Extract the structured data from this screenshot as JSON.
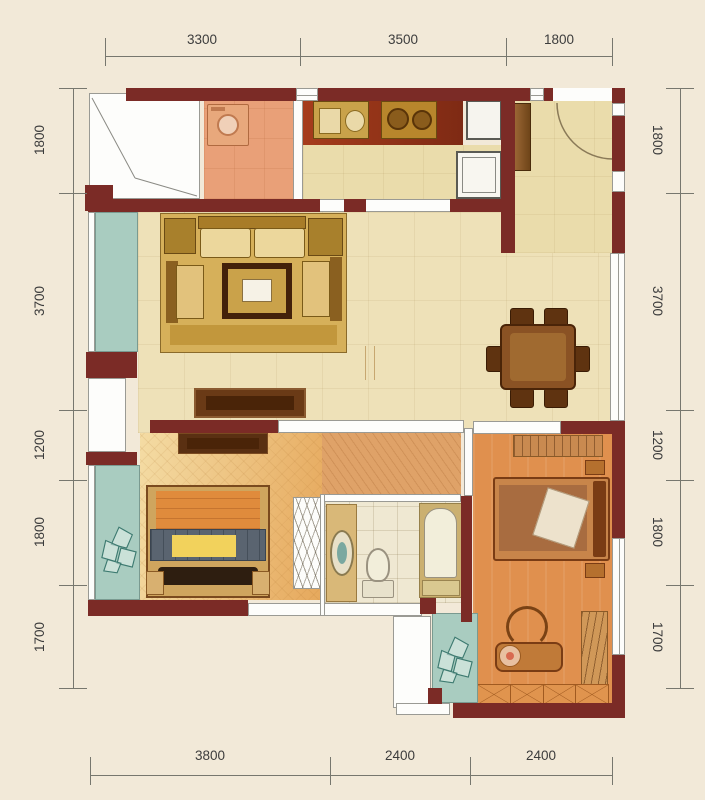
{
  "dims": {
    "top": [
      "3300",
      "3500",
      "1800"
    ],
    "bottom": [
      "3800",
      "2400",
      "2400"
    ],
    "left": [
      "1800",
      "3700",
      "1200",
      "1800",
      "1700"
    ],
    "right": [
      "1800",
      "3700",
      "1200",
      "1800",
      "1700"
    ]
  },
  "colors": {
    "page-bg": "#f2e9d8",
    "wall": "#7b2b26",
    "outline": "#9a9a94",
    "glass": "#a9ccc0",
    "glass-border": "#7a9a90",
    "floor-living": "#eee1b8",
    "floor-entry": "#eadcab",
    "floor-kitchen": "#e9a078",
    "floor-hall": "#dfa268",
    "floor-bed2-a": "#f4dca4",
    "floor-bed2-b": "#e6a85c",
    "floor-master": "#e0904e",
    "floor-bath": "#efe8d2",
    "counter-a": "#a63c1c",
    "counter-b": "#7e2a14",
    "appliance": "#c9a24a",
    "wood-dark": "#4a2408",
    "wood-mid": "#8a5224",
    "wood-light": "#c9935a",
    "sofa-rug": "#d6b05a",
    "cushion": "#ecd79c",
    "white": "#fdfdfb",
    "dim-text": "#3c3c3c",
    "dim-line": "#77776e",
    "plant": "#3d7a70"
  }
}
